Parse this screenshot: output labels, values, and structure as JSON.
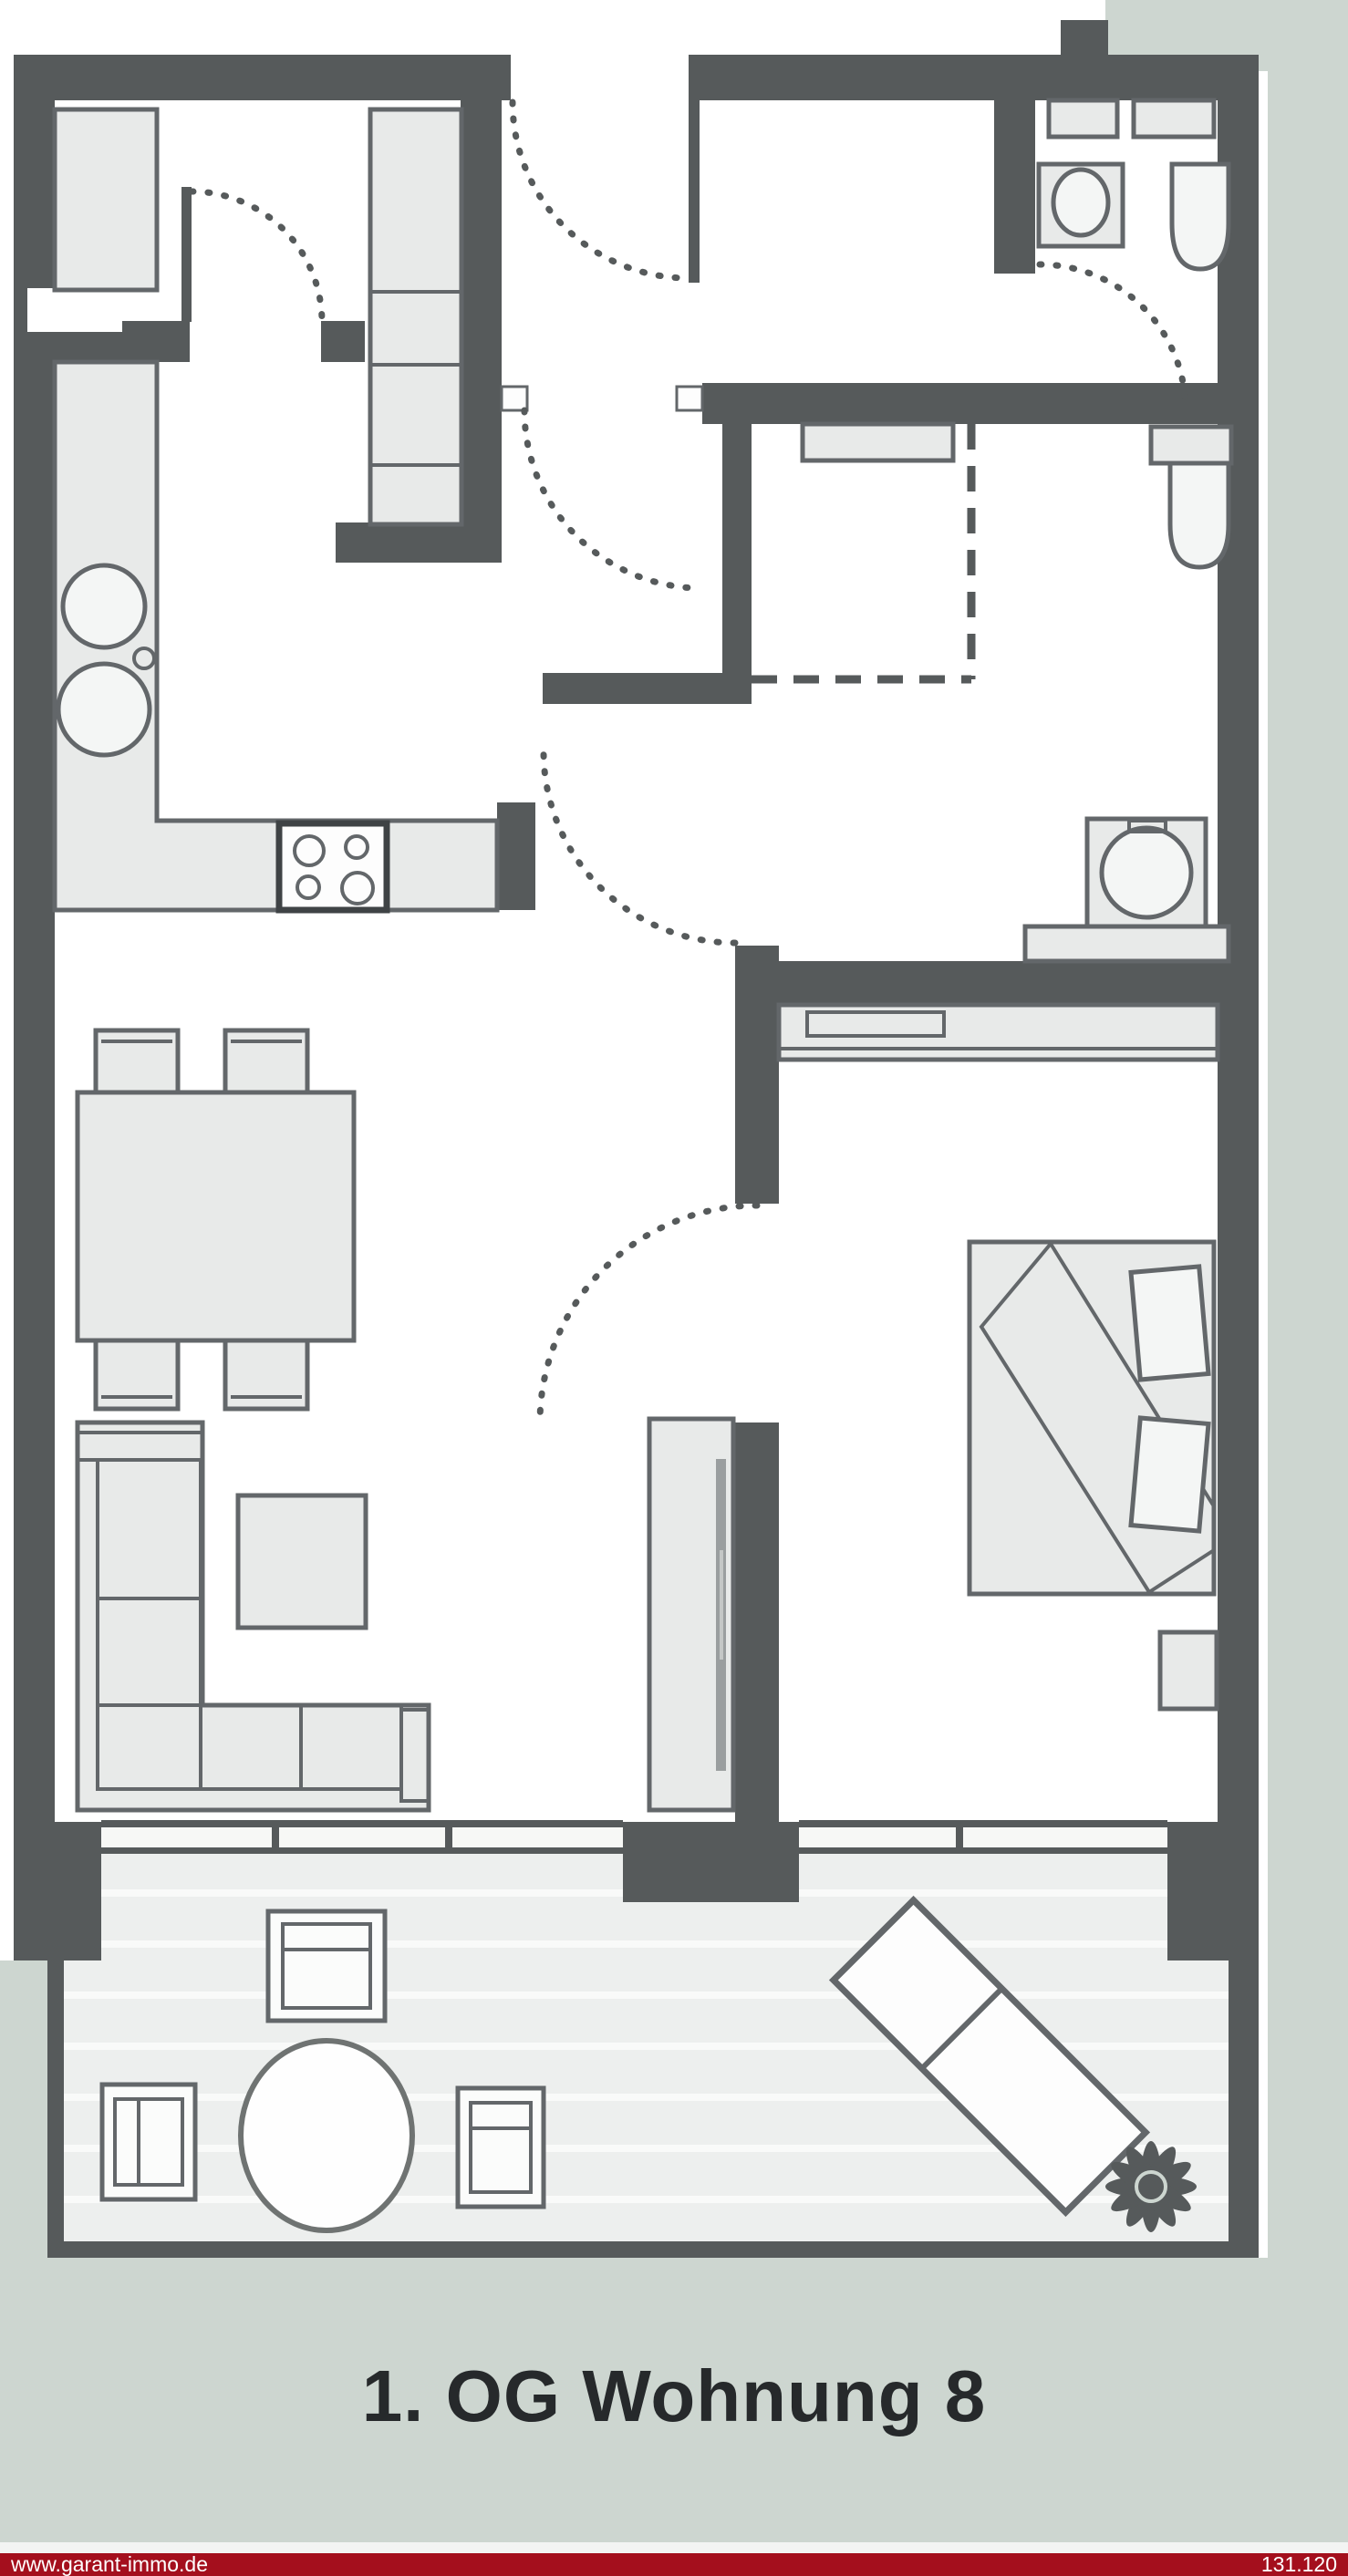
{
  "title": {
    "text": "1. OG Wohnung 8"
  },
  "footer": {
    "website": "www.garant-immo.de",
    "plan_number": "131.120"
  },
  "colors": {
    "bg": "#ffffff",
    "sage": "#cdd6d0",
    "wall": "#565a5b",
    "furn": "#e8eae9",
    "furn_stroke": "#63676a",
    "fixture": "#f4f6f5",
    "balcony_floor": "#edefee",
    "balcony_stripe": "#f9faf9",
    "title_color": "#26292b",
    "footer_bar": "#a40f1d",
    "footer_text": "#ffffff"
  }
}
